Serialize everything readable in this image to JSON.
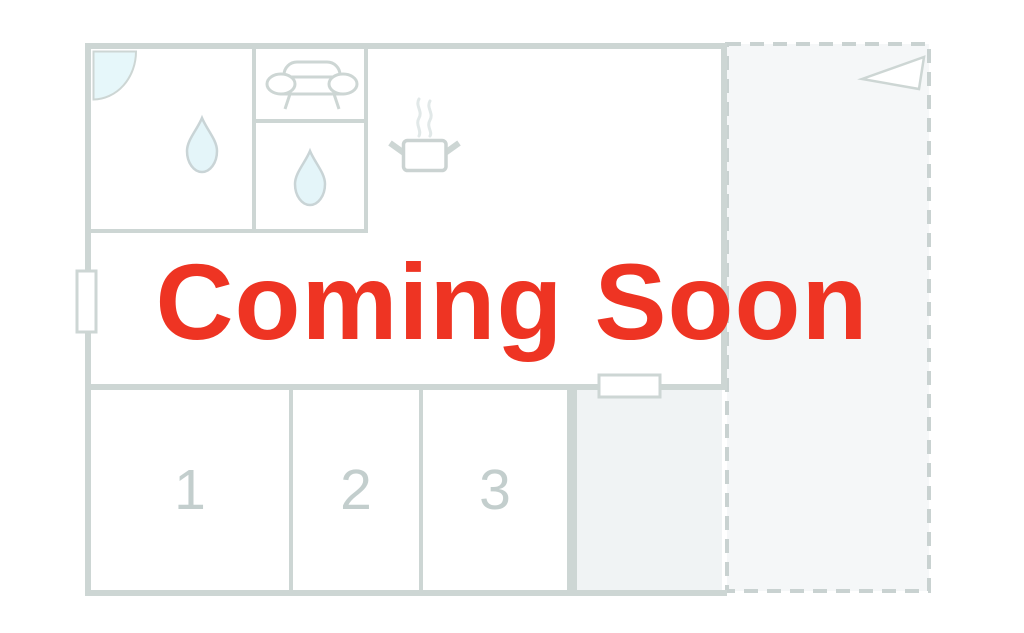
{
  "overlay": {
    "title": "Coming Soon",
    "title_color": "#ee3423"
  },
  "floorplan": {
    "rooms": [
      {
        "label": "1"
      },
      {
        "label": "2"
      },
      {
        "label": "3"
      }
    ],
    "icons": [
      {
        "name": "door-swing-icon"
      },
      {
        "name": "water-drop-icon"
      },
      {
        "name": "sofa-icon"
      },
      {
        "name": "water-drop-icon"
      },
      {
        "name": "steaming-pot-icon"
      },
      {
        "name": "direction-flag-icon"
      }
    ],
    "colors": {
      "wall": "#cdd6d4",
      "room_label": "#c3cecd",
      "water_fill": "#e4f5f9",
      "terrace_fill": "#f5f7f8",
      "utility_fill": "#f0f3f4",
      "dashed_border": "#c9d2d1"
    }
  }
}
